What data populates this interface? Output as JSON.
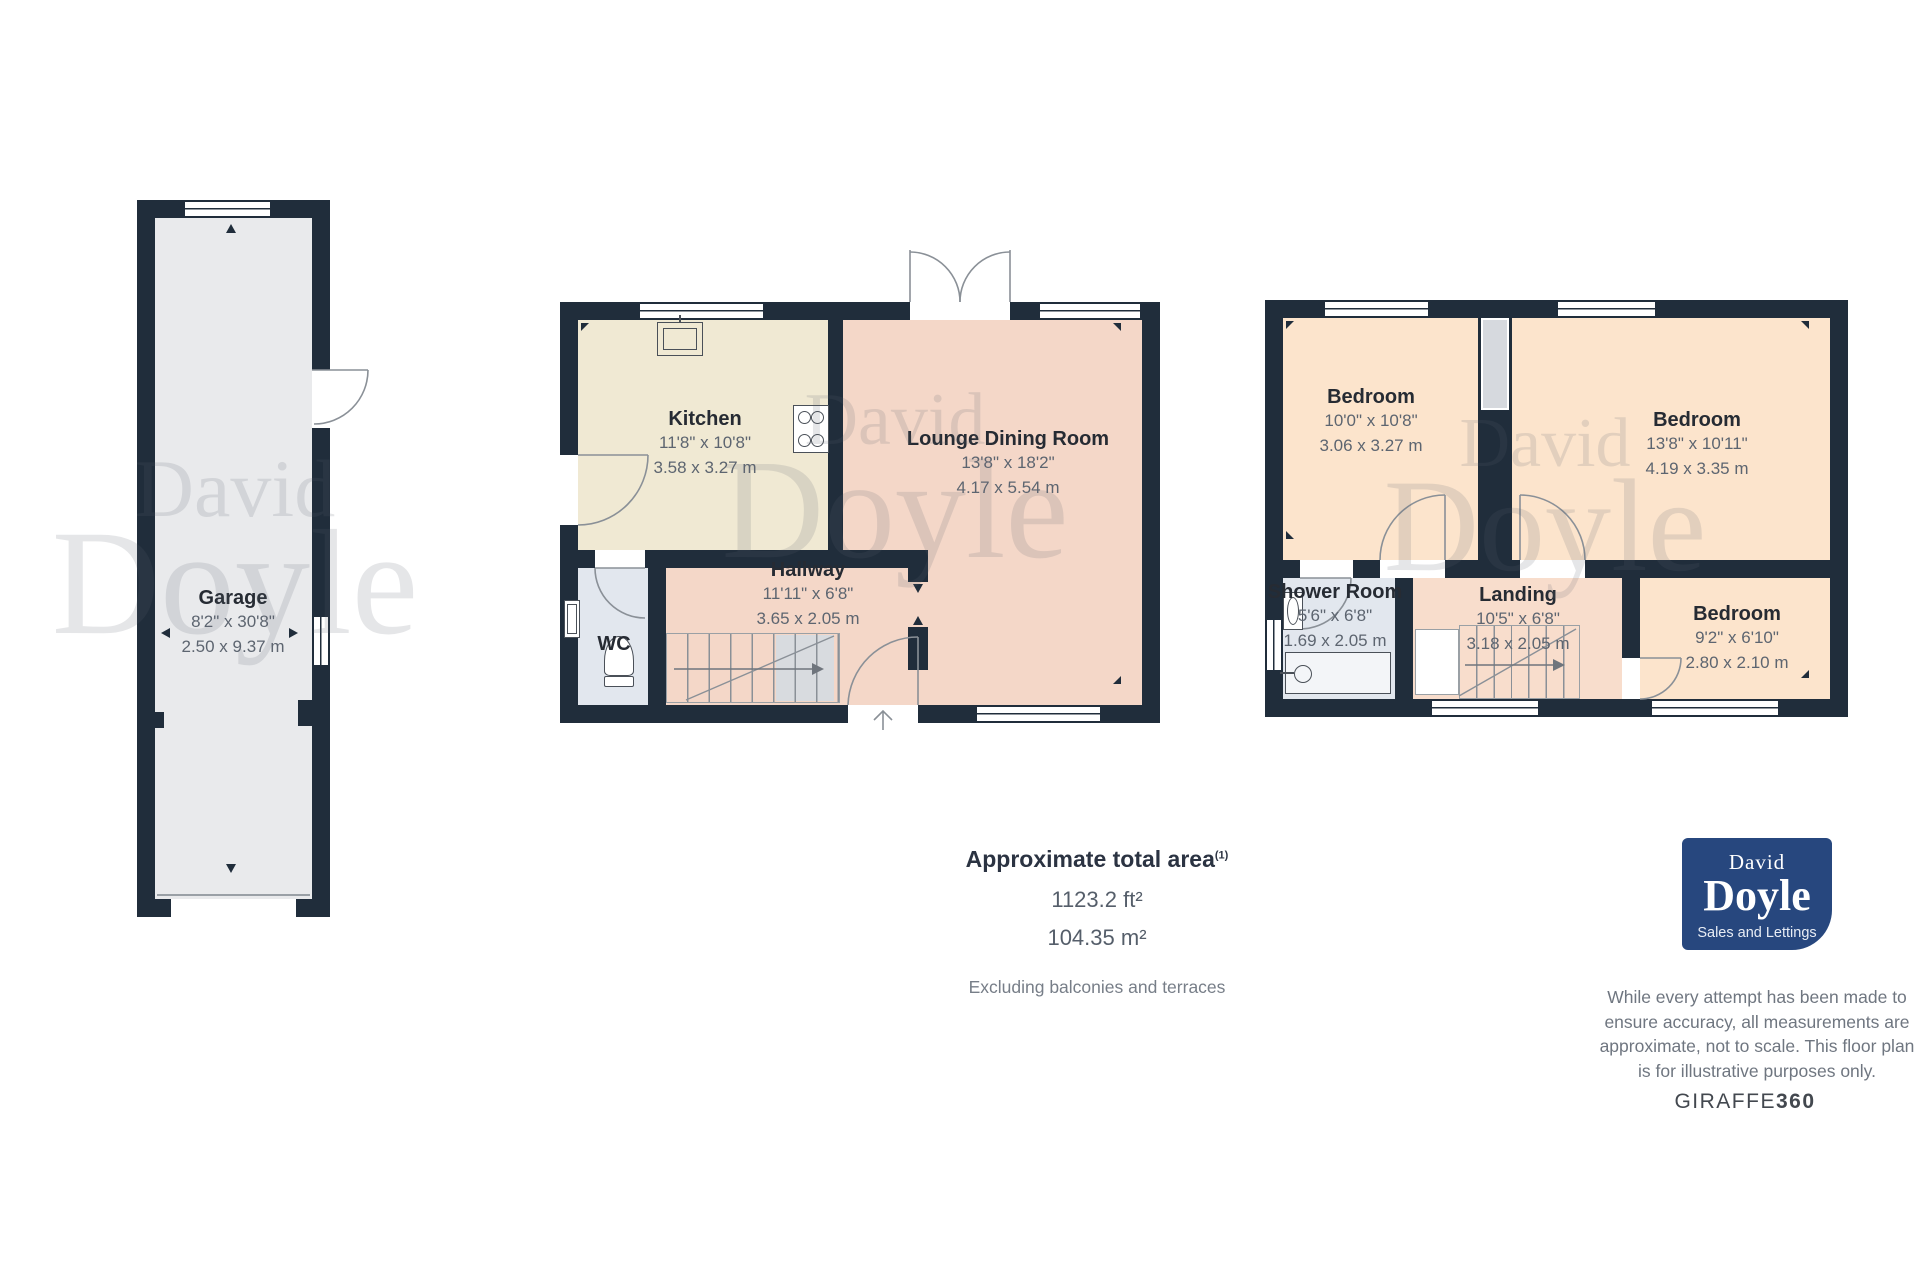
{
  "watermark": {
    "line1": "David",
    "line2": "Doyle"
  },
  "plans": {
    "garage": {
      "garage": {
        "name": "Garage",
        "imperial": "8'2\" x 30'8\"",
        "metric": "2.50 x 9.37 m"
      }
    },
    "ground": {
      "kitchen": {
        "name": "Kitchen",
        "imperial": "11'8\" x 10'8\"",
        "metric": "3.58 x 3.27 m"
      },
      "lounge": {
        "name": "Lounge Dining Room",
        "imperial": "13'8\" x 18'2\"",
        "metric": "4.17 x 5.54 m"
      },
      "hallway": {
        "name": "Hallway",
        "imperial": "11'11\" x 6'8\"",
        "metric": "3.65 x 2.05 m"
      },
      "wc": {
        "name": "WC"
      }
    },
    "first": {
      "bedroom1": {
        "name": "Bedroom",
        "imperial": "10'0\" x 10'8\"",
        "metric": "3.06 x 3.27 m"
      },
      "bedroom2": {
        "name": "Bedroom",
        "imperial": "13'8\" x 10'11\"",
        "metric": "4.19 x 3.35 m"
      },
      "shower": {
        "name": "Shower Room",
        "imperial": "5'6\" x 6'8\"",
        "metric": "1.69 x 2.05 m"
      },
      "landing": {
        "name": "Landing",
        "imperial": "10'5\" x 6'8\"",
        "metric": "3.18 x 2.05 m"
      },
      "bedroom3": {
        "name": "Bedroom",
        "imperial": "9'2\" x 6'10\"",
        "metric": "2.80 x 2.10 m"
      }
    }
  },
  "summary": {
    "title": "Approximate total area",
    "footnote": "(1)",
    "imperial": "1123.2 ft²",
    "metric": "104.35 m²",
    "note": "Excluding balconies and terraces"
  },
  "logo": {
    "top": "David",
    "name": "Doyle",
    "tagline": "Sales and Lettings"
  },
  "disclaimer": "While every attempt has been made to ensure accuracy, all measurements are approximate, not to scale. This floor plan is for illustrative purposes only.",
  "brand": {
    "name": "GIRAFFE",
    "suffix": "360"
  },
  "colors": {
    "wall": "#202d3b",
    "garage_fill": "#e9eaec",
    "kitchen_fill": "#f0e9d3",
    "lounge_fill": "#f4d7c8",
    "bedroom_fill": "#fce4cc",
    "landing_fill": "#f8ddcc",
    "bath_fill": "#e2e7ee",
    "cupboard_fill": "#d6d9de",
    "logo_bg": "#27477e"
  }
}
